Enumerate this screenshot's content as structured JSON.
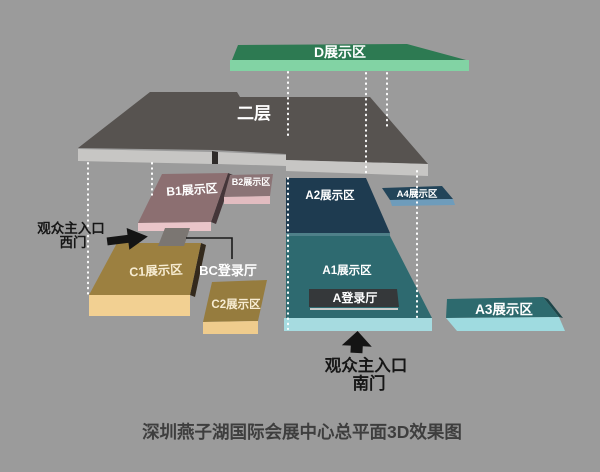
{
  "title": "深圳燕子湖国际会展中心总平面3D效果图",
  "blocks": {
    "d": {
      "label": "D展示区"
    },
    "second_floor": {
      "label": "二层"
    },
    "b1": {
      "label": "B1展示区"
    },
    "b2": {
      "label": "B2展示区"
    },
    "a2": {
      "label": "A2展示区"
    },
    "a4": {
      "label": "A4展示区"
    },
    "a1": {
      "label": "A1展示区"
    },
    "a_hall": {
      "label": "A登录厅"
    },
    "a3": {
      "label": "A3展示区"
    },
    "c1": {
      "label": "C1展示区"
    },
    "c2": {
      "label": "C2展示区"
    },
    "bc_hall": {
      "label": "BC登录厅"
    }
  },
  "entrances": {
    "west": {
      "line1": "观众主入口",
      "line2": "西门"
    },
    "south": {
      "line1": "观众主入口",
      "line2": "南门"
    }
  },
  "colors": {
    "background": "#9b9b9b",
    "d_top": "#2d7a52",
    "d_front": "#82d3a4",
    "floor2_top": "#575350",
    "floor2_front": "#c7c6c4",
    "floor2_notch": "#2e2b29",
    "b1_top": "#8c6f71",
    "b1_front": "#eac5c9",
    "b1_side": "#453639",
    "b2_top": "#8b7476",
    "b2_front": "#e2bcc0",
    "a2_top": "#1e3b50",
    "a2_a1_edge": "#4f8089",
    "a1_top": "#2e6a70",
    "a1_front": "#a6dbe0",
    "a_hall_panel": "#35383a",
    "a_hall_line": "#c9cbca",
    "a4_top": "#224459",
    "a4_front": "#6e9cbb",
    "a3_top": "#2d6a6e",
    "a3_side": "#1d4549",
    "a3_front": "#9fdbe0",
    "c1_top": "#9c8040",
    "c1_front": "#f2d092",
    "c1_side": "#33291c",
    "c2_top": "#967c3e",
    "c2_front": "#efcc8d",
    "bc_block": "#7b7672",
    "arrow_black": "#141414",
    "caption_text": "#3e3e3e"
  }
}
